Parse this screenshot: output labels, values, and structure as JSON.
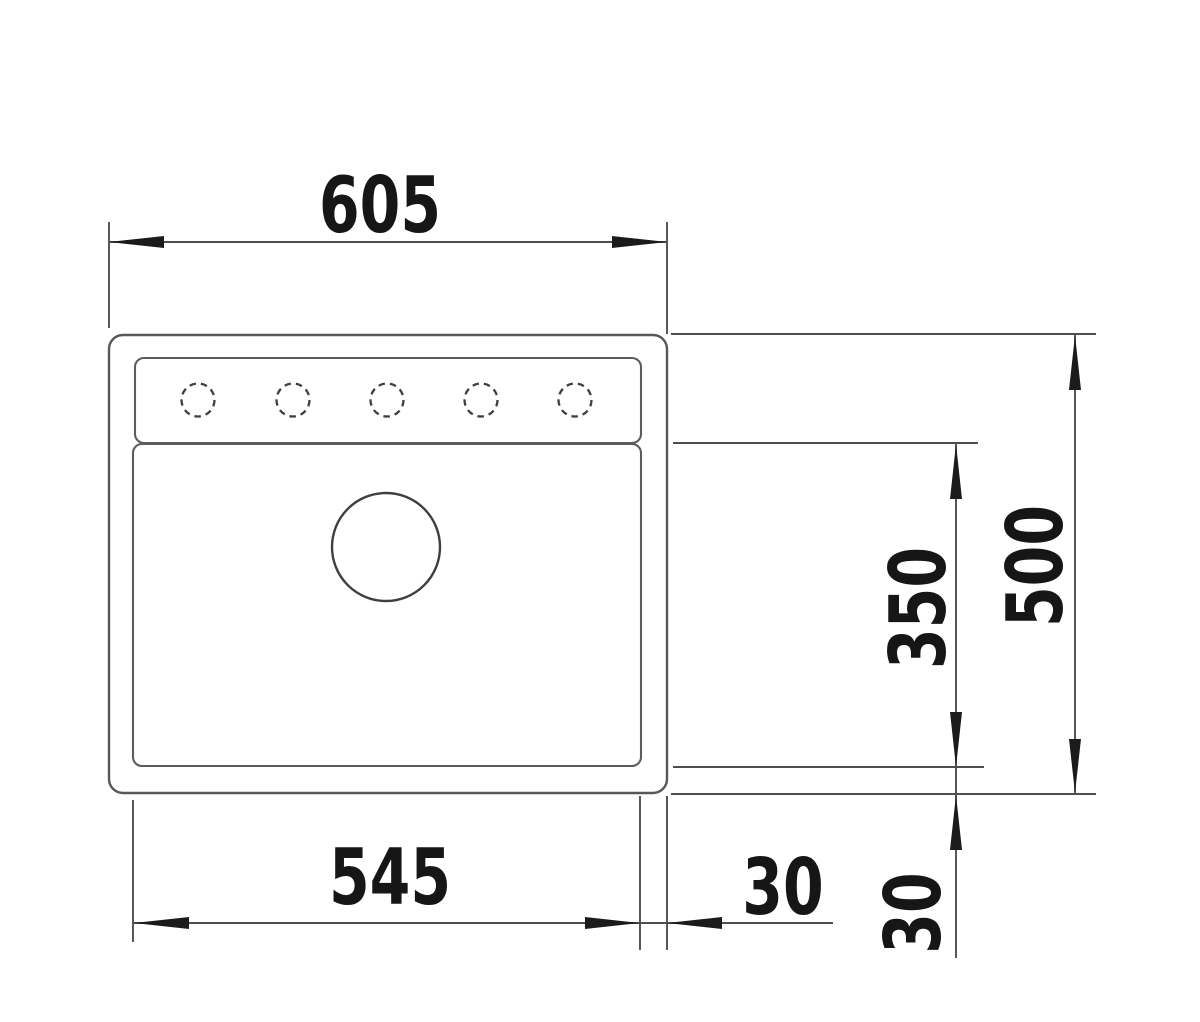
{
  "drawing": {
    "kind": "technical-dimension-drawing",
    "view": "sink-top-view",
    "features": {
      "tap_holes": 5,
      "drain_holes": 1
    },
    "colors": {
      "background": "#ffffff",
      "drawing_line": "#585858",
      "dimension_line": "#4e4e4e",
      "ink": "#161616"
    }
  },
  "dimensions": {
    "overall_width": "605",
    "overall_depth": "500",
    "bowl_depth": "350",
    "bowl_width": "545",
    "right_offset": "30",
    "bottom_offset": "30"
  }
}
